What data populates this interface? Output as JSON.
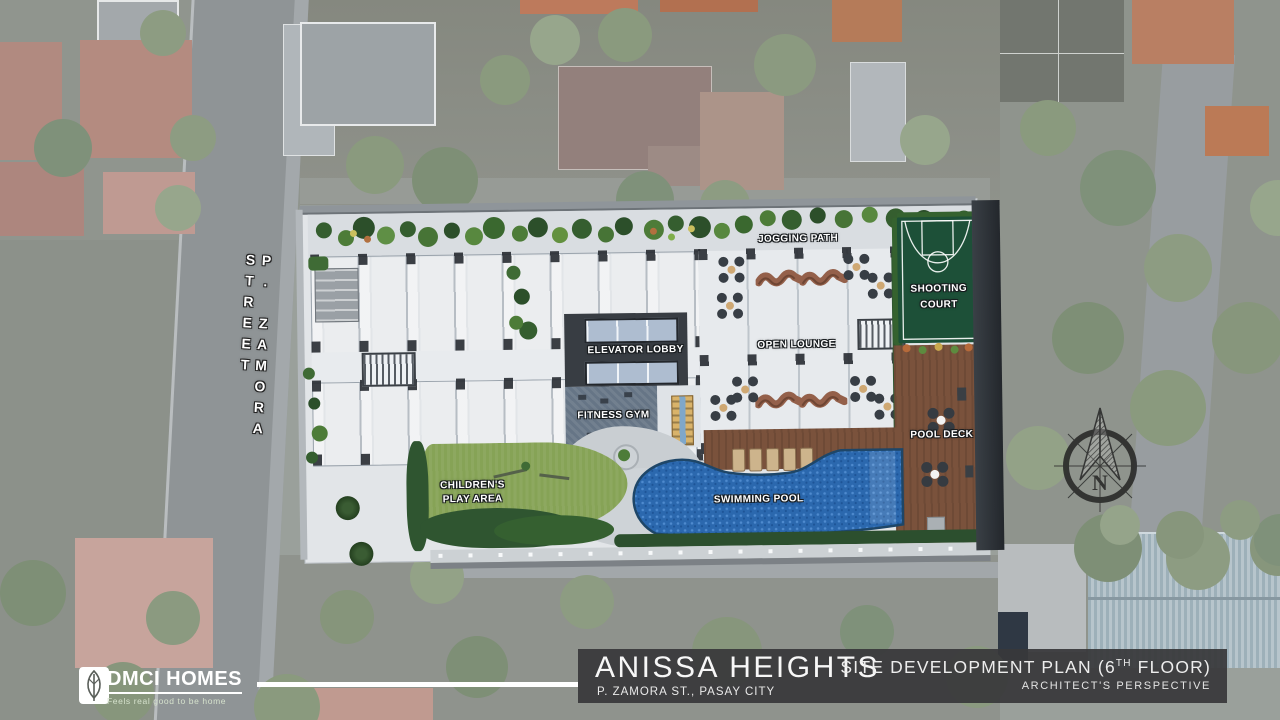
{
  "site_plan": {
    "street_label": "P. ZAMORA STREET",
    "amenities": {
      "jogging_path": "JOGGING PATH",
      "shooting_court": [
        "SHOOTING",
        "COURT"
      ],
      "elevator_lobby": "ELEVATOR LOBBY",
      "open_lounge": "OPEN LOUNGE",
      "fitness_gym": "FITNESS GYM",
      "pool_deck": "POOL DECK",
      "swimming_pool": "SWIMMING POOL",
      "childrens_play_area": [
        "CHILDREN'S",
        "PLAY AREA"
      ]
    },
    "compass_north": "N"
  },
  "footer": {
    "brand_name": "DMCI HOMES",
    "brand_tagline": "Feels real good to be home",
    "project_name": "ANISSA HEIGHTS",
    "project_address": "P. ZAMORA ST., PASAY CITY",
    "plan_title": {
      "prefix": "SITE DEVELOPMENT PLAN (6",
      "sup": "TH",
      "suffix": " FLOOR)"
    },
    "plan_subtitle": "ARCHITECT'S PERSPECTIVE"
  },
  "colors": {
    "pool_blue": "#2c6ab0",
    "lawn_green": "#86a356",
    "court_green": "#1d5038",
    "deck_brown": "#7a523c",
    "title_bar": "#3a3a3c",
    "label_text": "#ffffff"
  }
}
